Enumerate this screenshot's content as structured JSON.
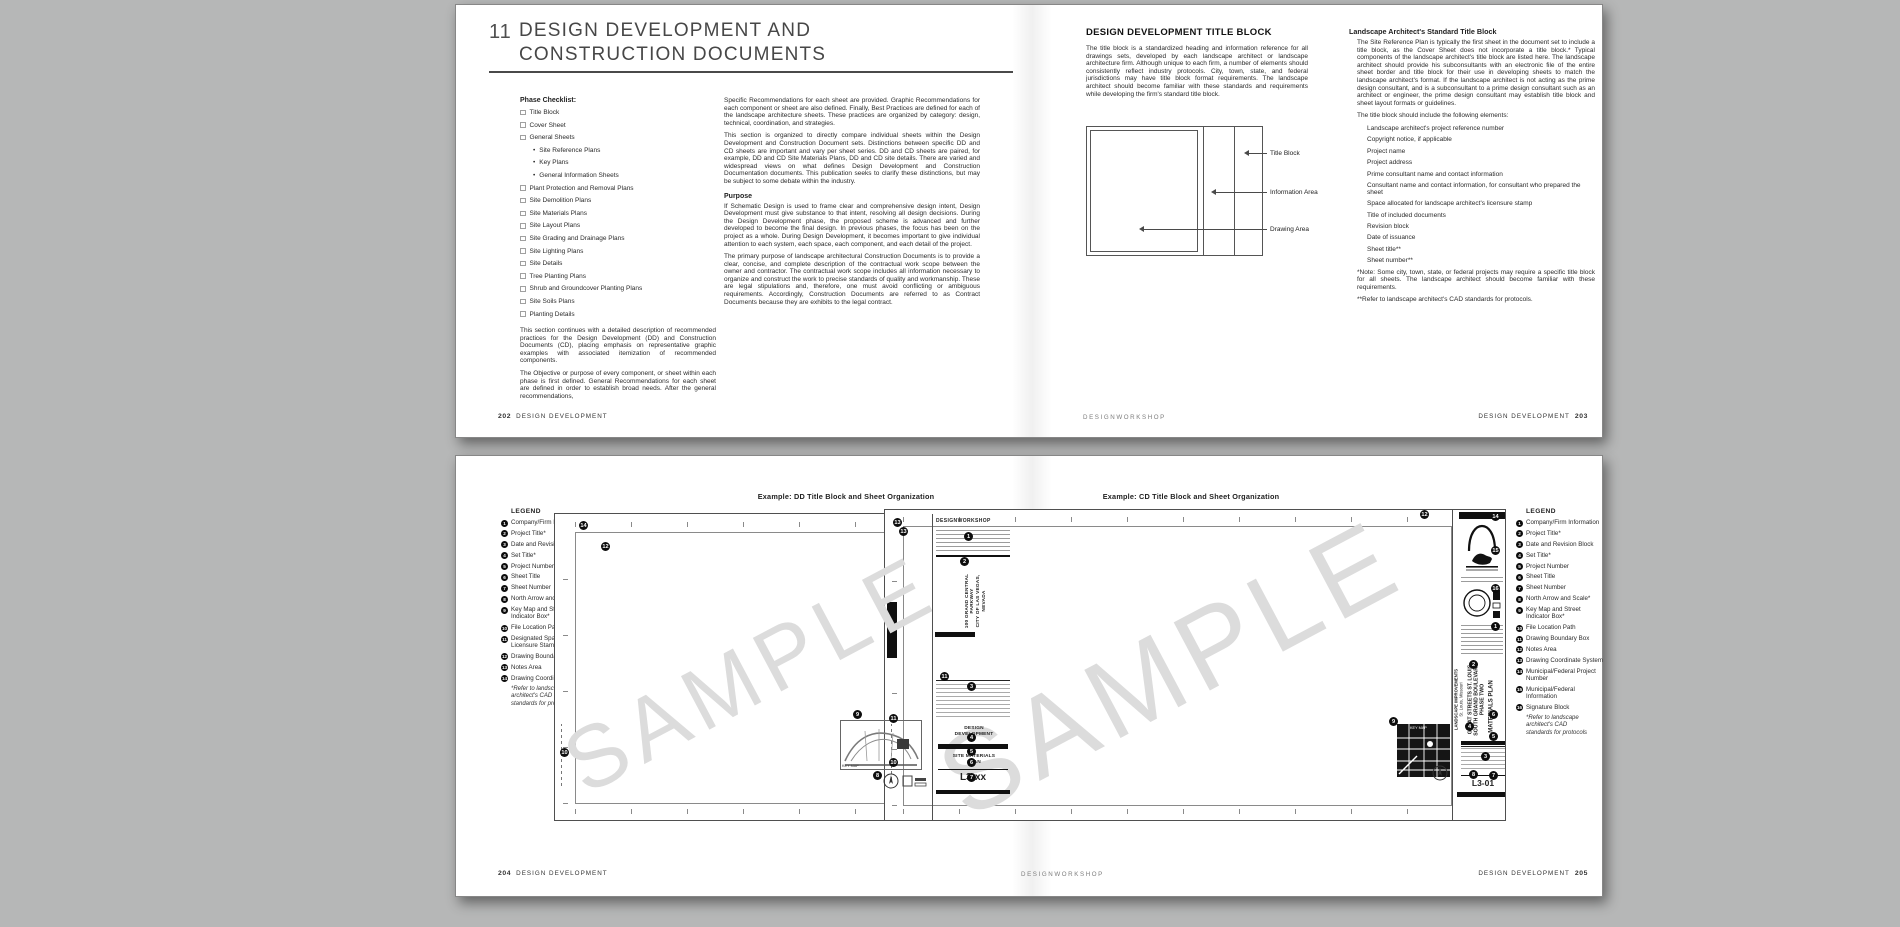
{
  "colors": {
    "background": "#b6b7b7",
    "page": "#ffffff",
    "text": "#2b2b2b",
    "watermark": "#dcdcdc",
    "callout": "#0d0d0d"
  },
  "spread_top": {
    "page_left": {
      "chapter_number": "11",
      "title_lines": [
        "DESIGN DEVELOPMENT AND",
        "CONSTRUCTION DOCUMENTS"
      ],
      "checklist_heading": "Phase Checklist:",
      "checklist": [
        {
          "label": "Title Block",
          "style": "checkbox"
        },
        {
          "label": "Cover Sheet",
          "style": "checkbox"
        },
        {
          "label": "General Sheets",
          "style": "checkbox"
        },
        {
          "label": "Site Reference Plans",
          "style": "bullet"
        },
        {
          "label": "Key Plans",
          "style": "bullet"
        },
        {
          "label": "General Information Sheets",
          "style": "bullet"
        },
        {
          "label": "Plant Protection and Removal Plans",
          "style": "checkbox"
        },
        {
          "label": "Site Demolition Plans",
          "style": "checkbox"
        },
        {
          "label": "Site Materials Plans",
          "style": "checkbox"
        },
        {
          "label": "Site Layout Plans",
          "style": "checkbox"
        },
        {
          "label": "Site Grading and Drainage Plans",
          "style": "checkbox"
        },
        {
          "label": "Site Lighting Plans",
          "style": "checkbox"
        },
        {
          "label": "Site Details",
          "style": "checkbox"
        },
        {
          "label": "Tree Planting Plans",
          "style": "checkbox"
        },
        {
          "label": "Shrub and Groundcover Planting Plans",
          "style": "checkbox"
        },
        {
          "label": "Site Soils Plans",
          "style": "checkbox"
        },
        {
          "label": "Planting Details",
          "style": "checkbox"
        }
      ],
      "col1_paras": [
        "This section continues with a detailed description of recommended practices for the Design Development (DD) and Construction Documents (CD), placing emphasis on representative graphic examples with associated itemization of recommended components.",
        "The Objective or purpose of every component, or sheet within each phase is first defined. General Recommendations for each sheet are defined in order to establish broad needs. After the general recommendations,"
      ],
      "col2_paras": [
        "Specific Recommendations for each sheet are provided. Graphic Recommendations for each component or sheet are also defined. Finally, Best Practices are defined for each of the landscape architecture sheets. These practices are organized by category: design, technical, coordination, and strategies.",
        "This section is organized to directly compare individual sheets within the Design Development and Construction Document sets. Distinctions between specific DD and CD sheets are important and vary per sheet series. DD and CD sheets are paired, for example, DD and CD Site Materials Plans, DD and CD site details. There are varied and widespread views on what defines Design Development and Construction Documentation documents. This publication seeks to clarify these distinctions, but may be subject to some debate within the industry."
      ],
      "purpose_heading": "Purpose",
      "purpose_paras": [
        "If Schematic Design is used to frame clear and comprehensive design intent, Design Development must give substance to that intent, resolving all design decisions. During the Design Development phase, the proposed scheme is advanced and further developed to become the final design. In previous phases, the focus has been on the project as a whole. During Design Development, it becomes important to give individual attention to each system, each space, each component, and each detail of the project.",
        "The primary purpose of landscape architectural Construction Documents is to provide a clear, concise, and complete description of the contractual work scope between the owner and contractor. The contractual work scope includes all information necessary to organize and construct the work to precise standards of quality and workmanship. These are legal stipulations and, therefore, one must avoid conflicting or ambiguous requirements. Accordingly, Construction Documents are referred to as Contract Documents because they are exhibits to the legal contract."
      ],
      "footer_page": "202",
      "footer_label": "DESIGN DEVELOPMENT"
    },
    "page_right": {
      "heading": "DESIGN DEVELOPMENT TITLE BLOCK",
      "intro": "The title block is a standardized heading and information reference for all drawings sets, developed by each landscape architect or landscape architecture firm. Although unique to each firm, a number of elements should consistently reflect industry protocols. City, town, state, and federal jurisdictions may have title block format requirements. The landscape architect should become familiar with these standards and requirements while developing the firm's standard title block.",
      "diagram_labels": {
        "title_block": "Title Block",
        "information_area": "Information Area",
        "drawing_area": "Drawing Area"
      },
      "right_heading": "Landscape Architect's Standard Title Block",
      "right_para": "The Site Reference Plan is typically the first sheet in the document set to include a title block, as the Cover Sheet does not incorporate a title block.* Typical components of the landscape architect's title block are listed here. The landscape architect should provide his subconsultants with an electronic file of the entire sheet border and title block for their use in developing sheets to match the landscape architect's format. If the landscape architect is not acting as the prime design consultant, and is a subconsultant to a prime design consultant such as an architect or engineer, the prime design consultant may establish title block and sheet layout formats or guidelines.",
      "elements_lead": "The title block should include the following elements:",
      "elements": [
        "Landscape architect's project reference number",
        "Copyright notice, if applicable",
        "Project name",
        "Project address",
        "Prime consultant name and contact information",
        "Consultant name and contact information, for consultant who prepared the sheet",
        "Space allocated for landscape architect's licensure stamp",
        "Title of included documents",
        "Revision block",
        "Date of issuance",
        "Sheet title**",
        "Sheet number**"
      ],
      "note1": "*Note: Some city, town, state, or federal projects may require a specific title block for all sheets. The landscape architect should become familiar with these requirements.",
      "note2": "**Refer to landscape architect's CAD standards for protocols.",
      "footer_brand": "DESIGNWORKSHOP",
      "footer_label": "DESIGN DEVELOPMENT",
      "footer_page": "203"
    }
  },
  "spread_bottom": {
    "page_left": {
      "example_title": "Example: DD Title Block and Sheet Organization",
      "legend_heading": "LEGEND",
      "legend": [
        {
          "n": "1",
          "label": "Company/Firm Information"
        },
        {
          "n": "2",
          "label": "Project Title*"
        },
        {
          "n": "3",
          "label": "Date and Revision Block"
        },
        {
          "n": "4",
          "label": "Set Title*"
        },
        {
          "n": "5",
          "label": "Project Number"
        },
        {
          "n": "6",
          "label": "Sheet Title"
        },
        {
          "n": "7",
          "label": "Sheet Number"
        },
        {
          "n": "8",
          "label": "North Arrow and Scale*"
        },
        {
          "n": "9",
          "label": "Key Map and Street Indicator Box*"
        },
        {
          "n": "10",
          "label": "File Location Path"
        },
        {
          "n": "11",
          "label": "Designated Space for Licensure Stamp"
        },
        {
          "n": "12",
          "label": "Drawing Boundary Box"
        },
        {
          "n": "13",
          "label": "Notes Area"
        },
        {
          "n": "14",
          "label": "Drawing Coordinate System"
        }
      ],
      "legend_note": "*Refer to landscape architect's CAD standards for protocols",
      "sheet": {
        "firm_logo": "DESIGNWORKSHOP",
        "project_title_line1": "100 GRAND CENTRAL PARKWAY",
        "project_title_line2": "CITY OF LAS VEGAS, NEVADA",
        "set_title": "DESIGN DEVELOPMENT",
        "sheet_title": "SITE MATERIALS PLAN",
        "sheet_number": "L3-xx",
        "key_map_label": "KEY MAP",
        "watermark": "SAMPLE"
      },
      "callouts": [
        {
          "n": "14",
          "x": 24,
          "y": 7
        },
        {
          "n": "12",
          "x": 46,
          "y": 28
        },
        {
          "n": "13",
          "x": 344,
          "y": 13
        },
        {
          "n": "1",
          "x": 409,
          "y": 18
        },
        {
          "n": "2",
          "x": 405,
          "y": 43
        },
        {
          "n": "11",
          "x": 385,
          "y": 158
        },
        {
          "n": "3",
          "x": 412,
          "y": 168
        },
        {
          "n": "4",
          "x": 412,
          "y": 219
        },
        {
          "n": "5",
          "x": 412,
          "y": 233
        },
        {
          "n": "6",
          "x": 412,
          "y": 244
        },
        {
          "n": "7",
          "x": 412,
          "y": 259
        },
        {
          "n": "9",
          "x": 298,
          "y": 196
        },
        {
          "n": "8",
          "x": 318,
          "y": 257
        },
        {
          "n": "10",
          "x": 5,
          "y": 234
        }
      ],
      "footer_page": "204",
      "footer_label": "DESIGN DEVELOPMENT"
    },
    "page_right": {
      "example_title": "Example: CD Title Block and Sheet Organization",
      "legend_heading": "LEGEND",
      "legend": [
        {
          "n": "1",
          "label": "Company/Firm Information"
        },
        {
          "n": "2",
          "label": "Project Title*"
        },
        {
          "n": "3",
          "label": "Date and Revision Block"
        },
        {
          "n": "4",
          "label": "Set Title*"
        },
        {
          "n": "5",
          "label": "Project Number"
        },
        {
          "n": "6",
          "label": "Sheet Title"
        },
        {
          "n": "7",
          "label": "Sheet Number"
        },
        {
          "n": "8",
          "label": "North Arrow and Scale*"
        },
        {
          "n": "9",
          "label": "Key Map and Street Indicator Box*"
        },
        {
          "n": "10",
          "label": "File Location Path"
        },
        {
          "n": "11",
          "label": "Drawing Boundary Box"
        },
        {
          "n": "12",
          "label": "Notes Area"
        },
        {
          "n": "13",
          "label": "Drawing Coordinate System"
        },
        {
          "n": "14",
          "label": "Municipal/Federal Project Number"
        },
        {
          "n": "15",
          "label": "Municipal/Federal Information"
        },
        {
          "n": "16",
          "label": "Signature Block"
        }
      ],
      "legend_note": "*Refer to landscape architect's CAD standards for protocols",
      "sheet": {
        "project_title_lines": [
          "GREAT STREETS ST. LOUIS",
          "SOUTH GRAND BOULEVARD",
          "PHASE TWO"
        ],
        "project_subtitle_lines": [
          "LANDSCAPE IMPROVEMENTS",
          "St. Louis, Missouri"
        ],
        "sheet_title": "MATERIALS PLAN",
        "sheet_number": "L3-01",
        "key_map_label": "KEY MAP",
        "watermark": "SAMPLE"
      },
      "callouts": [
        {
          "n": "13",
          "x": 8,
          "y": 8
        },
        {
          "n": "12",
          "x": 535,
          "y": 0
        },
        {
          "n": "14",
          "x": 606,
          "y": 2
        },
        {
          "n": "15",
          "x": 606,
          "y": 36
        },
        {
          "n": "16",
          "x": 606,
          "y": 74
        },
        {
          "n": "1",
          "x": 606,
          "y": 112
        },
        {
          "n": "2",
          "x": 584,
          "y": 150
        },
        {
          "n": "4",
          "x": 580,
          "y": 212
        },
        {
          "n": "6",
          "x": 604,
          "y": 200
        },
        {
          "n": "5",
          "x": 604,
          "y": 222
        },
        {
          "n": "3",
          "x": 596,
          "y": 242
        },
        {
          "n": "7",
          "x": 604,
          "y": 261
        },
        {
          "n": "8",
          "x": 584,
          "y": 260
        },
        {
          "n": "9",
          "x": 504,
          "y": 207
        },
        {
          "n": "11",
          "x": 4,
          "y": 204
        },
        {
          "n": "10",
          "x": 4,
          "y": 248
        }
      ],
      "footer_brand": "DESIGNWORKSHOP",
      "footer_label": "DESIGN DEVELOPMENT",
      "footer_page": "205"
    }
  }
}
